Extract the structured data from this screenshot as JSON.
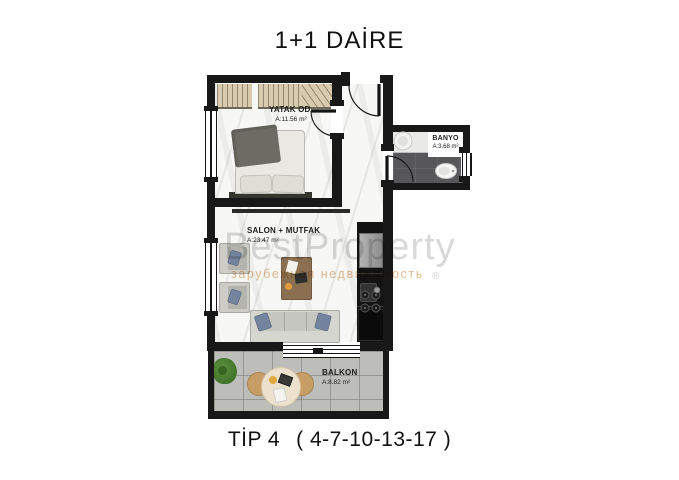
{
  "page": {
    "title": "1+1 DAİRE",
    "caption": {
      "type": "TİP 4",
      "units": "( 4-7-10-13-17 )"
    },
    "background_color": "#ffffff"
  },
  "floor_plan": {
    "wall_color": "#181818",
    "rooms": [
      {
        "id": "bedroom",
        "name": "YATAK OD.",
        "area": "A:11.56 m²"
      },
      {
        "id": "living_kitchen",
        "name": "SALON + MUTFAK",
        "area": "A:23.47 m²"
      },
      {
        "id": "bathroom",
        "name": "BANYO",
        "area": "A:3.68 m²"
      },
      {
        "id": "balcony",
        "name": "BALKON",
        "area": "A:8.82 m²"
      }
    ]
  },
  "watermark": {
    "brand": "BestProperty",
    "tagline": "зарубежная недвижимость",
    "registered": "®",
    "brand_color": "#d9d9d9",
    "tagline_color": "#d59450"
  }
}
